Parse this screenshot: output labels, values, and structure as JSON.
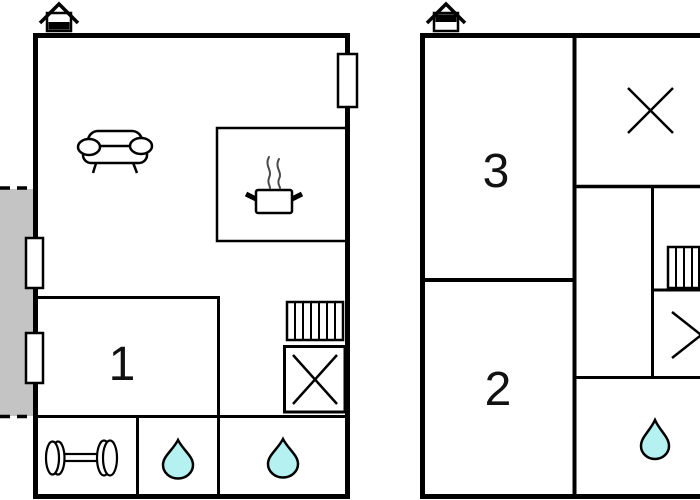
{
  "page": {
    "type": "floor-plan-drawing",
    "background": "#ffffff"
  },
  "colors": {
    "wall": "#000000",
    "terrace_fill": "#c4c4c4",
    "water_drop_fill": "#b5f1f1",
    "steam": "#4a4a4a"
  },
  "plans": {
    "ground_floor": {
      "rooms": [
        {
          "id": "room-1",
          "label": "1"
        }
      ],
      "features": [
        "entrance-house-icon",
        "terrace-area",
        "window-marker",
        "window-marker",
        "window-marker",
        "sofa-icon",
        "kitchen-area",
        "cooking-pot-icon",
        "stairs-icon",
        "shower-cross-icon",
        "dumbbell-icon",
        "water-drop-icon",
        "water-drop-icon"
      ]
    },
    "upper_floor": {
      "rooms": [
        {
          "id": "room-3",
          "label": "3"
        },
        {
          "id": "room-2",
          "label": "2"
        }
      ],
      "features": [
        "entrance-house-icon",
        "cross-symbol",
        "stairs-icon",
        "cross-symbol",
        "water-drop-icon"
      ]
    }
  }
}
